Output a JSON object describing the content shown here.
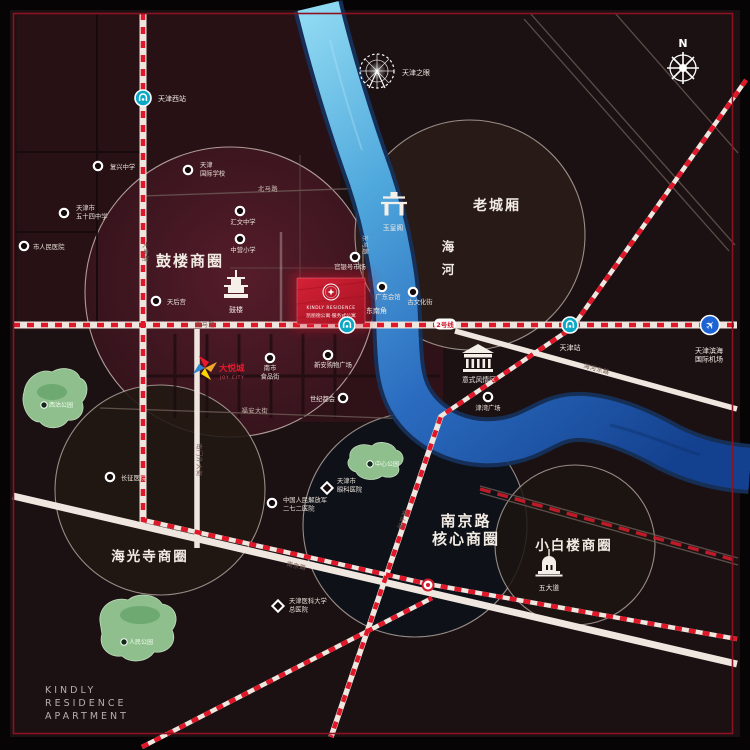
{
  "colors": {
    "accent_red": "#e01729",
    "frame_red": "#8c1220",
    "river_light": "#8fd9f2",
    "river_dark": "#14418f",
    "metro_teal": "#0ba8c6",
    "airport_blue": "#1c64d4",
    "park_green": "#8fbf8c",
    "project_red": "#c61b2e"
  },
  "frame": {
    "brand_lines": [
      "KINDLY",
      "RESIDENCE",
      "APARTMENT"
    ]
  },
  "compass": {
    "label": "N"
  },
  "project": {
    "line_en": "KINDLY RESIDENCE",
    "line_cn": "凯丽德公寓·服务式公寓"
  },
  "districts": {
    "gulou": "鼓楼商圈",
    "laochengxiang": "老城厢",
    "nanjing_1": "南京路",
    "nanjing_2": "核心商圈",
    "xiaobailou": "小白楼商圈",
    "haiguangsi": "海光寺商圈",
    "river_1": "海",
    "river_2": "河"
  },
  "landmarks": {
    "ferris": {
      "label": "天津之眼"
    },
    "drum_tower": {
      "label": "鼓楼"
    },
    "yuhuangge": {
      "label": "玉皇阁"
    },
    "italian_town": {
      "label": "意式风情区"
    },
    "wudadao": {
      "label": "五大道"
    }
  },
  "joycity": {
    "label": "大悦城",
    "sub": "JOY CITY"
  },
  "metro_line_badge": {
    "x": 445,
    "y": 327,
    "label": "2号线"
  },
  "stations": [
    {
      "name": "tianjin-west-station",
      "type": "metro",
      "x": 143,
      "y": 98,
      "label": {
        "x": 158,
        "y": 101,
        "anchor": "start",
        "lines": [
          "天津西站"
        ]
      }
    },
    {
      "name": "dongnanjiao-station",
      "type": "metro",
      "x": 347,
      "y": 325,
      "label": {
        "x": 366,
        "y": 313,
        "anchor": "start",
        "lines": [
          "东南角"
        ]
      }
    },
    {
      "name": "tianjin-station",
      "type": "metro",
      "x": 570,
      "y": 325,
      "label": {
        "x": 570,
        "y": 350,
        "anchor": "middle",
        "lines": [
          "天津站"
        ]
      }
    },
    {
      "name": "yingkoudao-station",
      "type": "interchange",
      "x": 428,
      "y": 585,
      "label": null
    },
    {
      "name": "binhai-airport",
      "type": "airport",
      "x": 710,
      "y": 325,
      "label": {
        "x": 709,
        "y": 353,
        "anchor": "middle",
        "lines": [
          "天津滨海",
          "国际机场"
        ]
      }
    }
  ],
  "pois": [
    {
      "name": "poi-fuxing-school",
      "shape": "dot",
      "x": 98,
      "y": 166,
      "label": {
        "x": 110,
        "y": 169,
        "anchor": "start",
        "lines": [
          "复兴中学"
        ]
      }
    },
    {
      "name": "poi-no54-school",
      "shape": "dot",
      "x": 64,
      "y": 213,
      "label": {
        "x": 76,
        "y": 210,
        "anchor": "start",
        "lines": [
          "天津市",
          "五十四中学"
        ]
      }
    },
    {
      "name": "poi-intl-school",
      "shape": "dot",
      "x": 188,
      "y": 170,
      "label": {
        "x": 200,
        "y": 167,
        "anchor": "start",
        "lines": [
          "天津",
          "国际学校"
        ]
      }
    },
    {
      "name": "poi-huiwen-school",
      "shape": "dot",
      "x": 240,
      "y": 211,
      "label": {
        "x": 243,
        "y": 224,
        "anchor": "middle",
        "lines": [
          "汇文中学"
        ]
      }
    },
    {
      "name": "poi-zhongying-school",
      "shape": "dot",
      "x": 240,
      "y": 239,
      "label": {
        "x": 243,
        "y": 252,
        "anchor": "middle",
        "lines": [
          "中营小学"
        ]
      }
    },
    {
      "name": "poi-renmin-hospital",
      "shape": "dot",
      "x": 24,
      "y": 246,
      "label": {
        "x": 33,
        "y": 249,
        "anchor": "start",
        "lines": [
          "市人民医院"
        ]
      }
    },
    {
      "name": "poi-tianhougong",
      "shape": "dot",
      "x": 156,
      "y": 301,
      "label": {
        "x": 167,
        "y": 304,
        "anchor": "start",
        "lines": [
          "天后宫"
        ]
      }
    },
    {
      "name": "poi-guanyinhao",
      "shape": "dot",
      "x": 355,
      "y": 257,
      "label": {
        "x": 350,
        "y": 269,
        "anchor": "middle",
        "lines": [
          "官银号市场"
        ]
      }
    },
    {
      "name": "poi-guangdong-huiguan",
      "shape": "dot",
      "x": 382,
      "y": 287,
      "label": {
        "x": 388,
        "y": 299,
        "anchor": "middle",
        "lines": [
          "广东会馆"
        ]
      }
    },
    {
      "name": "poi-guwenhuajie",
      "shape": "dot",
      "x": 413,
      "y": 292,
      "label": {
        "x": 420,
        "y": 304,
        "anchor": "middle",
        "lines": [
          "古文化街"
        ]
      }
    },
    {
      "name": "poi-nanshi-food-street",
      "shape": "dot",
      "x": 270,
      "y": 358,
      "label": {
        "x": 270,
        "y": 370,
        "anchor": "middle",
        "lines": [
          "南市",
          "食品街"
        ]
      }
    },
    {
      "name": "poi-xinan-plaza",
      "shape": "dot",
      "x": 328,
      "y": 355,
      "label": {
        "x": 333,
        "y": 367,
        "anchor": "middle",
        "lines": [
          "新安购物广场"
        ]
      }
    },
    {
      "name": "poi-shijiduhui",
      "shape": "dot",
      "x": 343,
      "y": 398,
      "label": {
        "x": 335,
        "y": 401,
        "anchor": "end",
        "lines": [
          "世纪都会"
        ]
      }
    },
    {
      "name": "poi-jinwan-plaza",
      "shape": "dot",
      "x": 488,
      "y": 397,
      "label": {
        "x": 488,
        "y": 410,
        "anchor": "middle",
        "lines": [
          "津湾广场"
        ]
      }
    },
    {
      "name": "poi-changzheng-hospital",
      "shape": "dot",
      "x": 110,
      "y": 477,
      "label": {
        "x": 121,
        "y": 480,
        "anchor": "start",
        "lines": [
          "长征医院"
        ]
      }
    },
    {
      "name": "poi-272-hospital",
      "shape": "dot",
      "x": 272,
      "y": 503,
      "label": {
        "x": 283,
        "y": 502,
        "anchor": "start",
        "lines": [
          "中国人民解放军",
          "二七二医院"
        ]
      }
    },
    {
      "name": "poi-eye-hospital",
      "shape": "diamond",
      "x": 327,
      "y": 488,
      "label": {
        "x": 337,
        "y": 483,
        "anchor": "start",
        "lines": [
          "天津市",
          "眼科医院"
        ]
      }
    },
    {
      "name": "poi-medical-univ-hospital",
      "shape": "diamond",
      "x": 278,
      "y": 606,
      "label": {
        "x": 289,
        "y": 603,
        "anchor": "start",
        "lines": [
          "天津医科大学",
          "总医院"
        ]
      }
    }
  ],
  "parks": [
    {
      "name": "park-xigu",
      "label": "西沽公园",
      "x": 52,
      "y": 407
    },
    {
      "name": "park-renmin",
      "label": "人民公园",
      "x": 132,
      "y": 644
    },
    {
      "name": "park-zhongxin",
      "label": "中心公园",
      "x": 378,
      "y": 466
    }
  ],
  "road_labels": [
    {
      "name": "road-dafeng",
      "text": "大丰路",
      "x": 143,
      "y": 252,
      "rotate": 90,
      "dark": true
    },
    {
      "name": "road-nanmenwai",
      "text": "南门外大街",
      "x": 197,
      "y": 460,
      "rotate": 90,
      "dark": true
    },
    {
      "name": "road-dongmalu",
      "text": "东马路",
      "x": 363,
      "y": 245,
      "rotate": 90,
      "dark": false
    },
    {
      "name": "road-beimalu",
      "text": "北马路",
      "x": 268,
      "y": 191,
      "rotate": 0,
      "dark": false
    },
    {
      "name": "road-nanmalu",
      "text": "南马路",
      "x": 205,
      "y": 327,
      "rotate": 0,
      "dark": true
    },
    {
      "name": "road-fuan",
      "text": "福安大街",
      "x": 255,
      "y": 413,
      "rotate": 0,
      "dark": false
    },
    {
      "name": "road-nanjinglu",
      "text": "南京路",
      "x": 296,
      "y": 568,
      "rotate": 13,
      "dark": true
    },
    {
      "name": "road-haihedonglu",
      "text": "海河东路",
      "x": 596,
      "y": 371,
      "rotate": 15,
      "dark": true
    },
    {
      "name": "road-hepinglu",
      "text": "和平路",
      "x": 405,
      "y": 520,
      "rotate": -71,
      "dark": true
    }
  ]
}
